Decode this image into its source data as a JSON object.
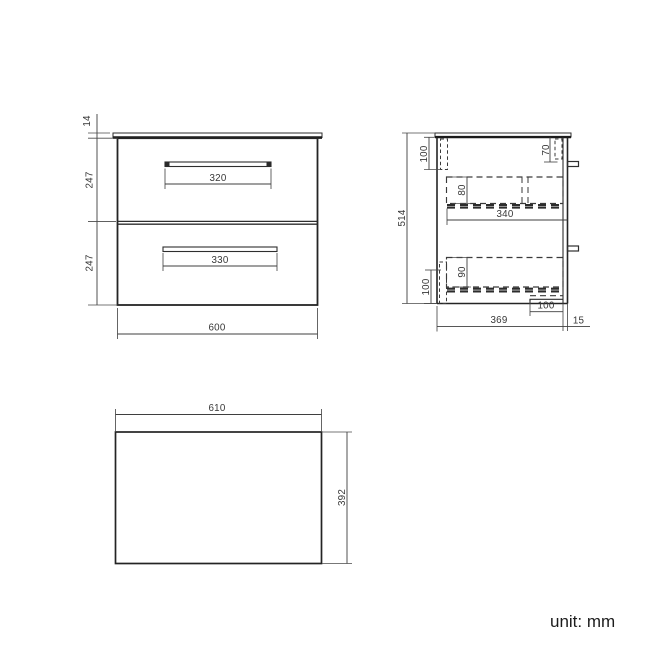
{
  "unit_note": "unit: mm",
  "front_view": {
    "countertop_thickness_mm": "14",
    "top_drawer_height_mm": "247",
    "bottom_drawer_height_mm": "247",
    "top_handle_width_mm": "320",
    "bottom_handle_width_mm": "330",
    "overall_width_mm": "600"
  },
  "side_view": {
    "overall_height_mm": "514",
    "top_left_clearance_mm": "100",
    "top_right_clearance_mm": "70",
    "top_drawer_depth_mm": "80",
    "drawer_length_mm": "340",
    "bottom_drawer_depth_mm": "90",
    "bottom_left_clearance_mm": "100",
    "bottom_recess_width_mm": "100",
    "overall_depth_mm": "369",
    "handle_projection_mm": "15"
  },
  "top_view": {
    "countertop_width_mm": "610",
    "countertop_depth_mm": "392"
  }
}
